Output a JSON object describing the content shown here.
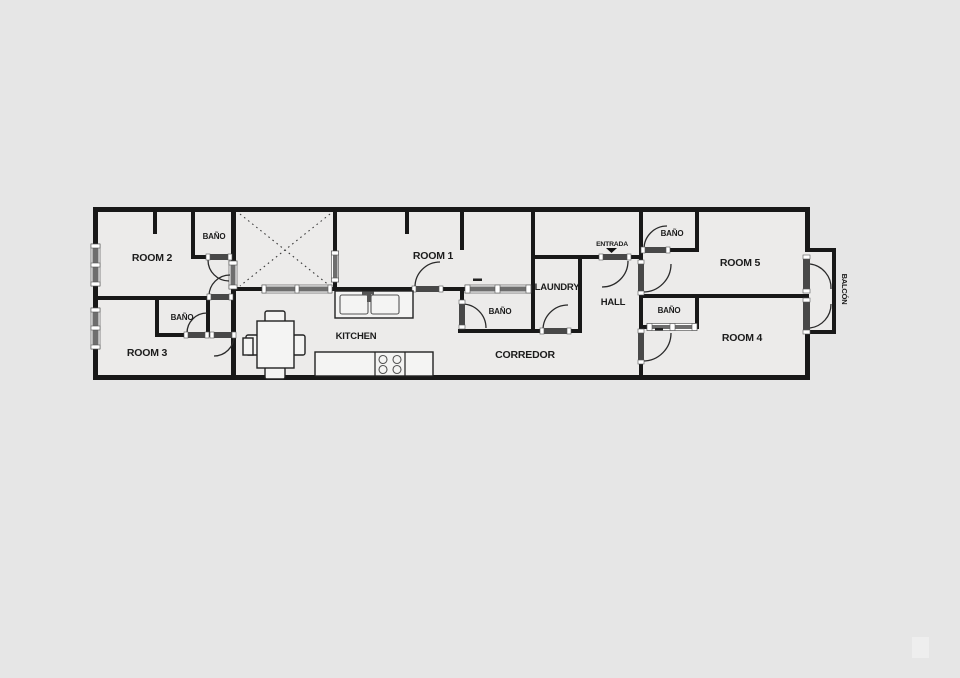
{
  "document": {
    "type": "apartment-floor-plan"
  },
  "labels": {
    "room1": "ROOM 1",
    "room2": "ROOM 2",
    "room3": "ROOM 3",
    "room4": "ROOM 4",
    "room5": "ROOM 5",
    "bano": "BAÑO",
    "kitchen": "KITCHEN",
    "laundry": "LAUNDRY",
    "hall": "HALL",
    "corredor": "CORREDOR",
    "entrada": "ENTRADA",
    "balcon": "BALCÓN"
  },
  "bath_count": 5,
  "colors": {
    "background": "#e6e6e6",
    "room_fill": "#ecebea",
    "wall": "#181818",
    "door": "#484848",
    "window": "#6e6e6e",
    "text": "#1c1c1c"
  }
}
